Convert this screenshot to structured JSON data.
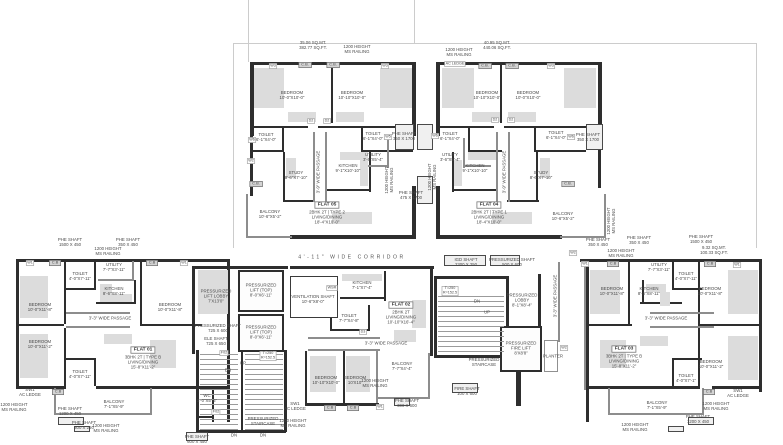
{
  "drawing_title": "TYPICAL FLOOR PLAN",
  "colors": {
    "wall": "#2e2e2e",
    "light_wall": "#8d8d8d",
    "furniture": "#dcdcdc",
    "text": "#4a4a4a",
    "faint_line": "#cccccc"
  },
  "flats": [
    {
      "name": "FLAT 01",
      "type": "3BHK 2T | TYPE B",
      "living": "LIVING/DINING 15'-8\"X11'-2\""
    },
    {
      "name": "FLAT 02",
      "type": "2BHK 2T",
      "living": "LIVING/DINING 10'-10\"X16'-4\""
    },
    {
      "name": "FLAT 03",
      "type": "3BHK 2T | TYPE B",
      "living": "LIVING/DINING 15'-8\"X11'-2\""
    },
    {
      "name": "FLAT 04",
      "type": "2BHK 2T | TYPE 1",
      "living": "LIVING/DINING 18'-4\"X10'-0\""
    },
    {
      "name": "FLAT 05",
      "type": "2BHK 2T | TYPE 2",
      "living": "LIVING/DINING 18'-4\"X10'-0\""
    }
  ],
  "labels": [
    {
      "id": "area-note-flat05",
      "t": "35.06 SQ.MT.\n382.77 SQ.FT.",
      "x": 313,
      "y": 46
    },
    {
      "id": "railing-note",
      "t": "1200 HEIGHT\nMS RAILING",
      "x": 357,
      "y": 50
    },
    {
      "id": "window-tag",
      "t": "W3",
      "x": 273,
      "y": 66,
      "cls": "tag"
    },
    {
      "id": "cupboard",
      "t": "C.B.",
      "x": 305,
      "y": 65,
      "cls": "cb"
    },
    {
      "id": "cupboard",
      "t": "C.B.",
      "x": 333,
      "y": 65,
      "cls": "cb"
    },
    {
      "id": "window-tag",
      "t": "W3",
      "x": 385,
      "y": 66,
      "cls": "tag"
    },
    {
      "id": "room-bedroom",
      "t": "BEDROOM\n10'-0\"X10'-0\"",
      "x": 292,
      "y": 96
    },
    {
      "id": "room-bedroom",
      "t": "BEDROOM\n10'-10\"X10'-0\"",
      "x": 352,
      "y": 96
    },
    {
      "id": "door-tag",
      "t": "D2",
      "x": 311,
      "y": 121,
      "cls": "tag"
    },
    {
      "id": "door-tag",
      "t": "D2",
      "x": 327,
      "y": 121,
      "cls": "tag"
    },
    {
      "id": "window-tag",
      "t": "W6",
      "x": 252,
      "y": 140,
      "cls": "tag"
    },
    {
      "id": "room-toilet",
      "t": "TOILET\n6'-1\"X4'-0\"",
      "x": 266,
      "y": 138
    },
    {
      "id": "room-toilet",
      "t": "TOILET\n6'-1\"X4'-0\"",
      "x": 373,
      "y": 137
    },
    {
      "id": "window-tag",
      "t": "W5",
      "x": 388,
      "y": 137,
      "cls": "tag"
    },
    {
      "id": "shaft-note",
      "t": "PHE SHAFT\n350 X 1700",
      "x": 404,
      "y": 137
    },
    {
      "id": "window-tag",
      "t": "W2",
      "x": 251,
      "y": 161,
      "cls": "tag"
    },
    {
      "id": "room-study",
      "t": "STUDY\n8'-6\"X7'-10\"",
      "x": 296,
      "y": 176
    },
    {
      "id": "passage-note",
      "t": "3'-9\" WIDE PASSAGE",
      "x": 319,
      "y": 172,
      "v": 1
    },
    {
      "id": "room-kitchen",
      "t": "KITCHEN\n9'-1\"X10'-10\"",
      "x": 348,
      "y": 169
    },
    {
      "id": "room-utility",
      "t": "UTILITY\n3'-6\"X5'-4\"",
      "x": 373,
      "y": 158
    },
    {
      "id": "cupboard",
      "t": "C.B.",
      "x": 256,
      "y": 184,
      "cls": "cb"
    },
    {
      "id": "flat-name",
      "t": "FLAT 05",
      "x": 327,
      "y": 205,
      "cls": "fname"
    },
    {
      "id": "flat-info",
      "t": "2BHK 2T | TYPE 2\nLIVING/DINING\n18'-4\"X10'-0\"",
      "x": 327,
      "y": 218
    },
    {
      "id": "room-balcony",
      "t": "BALCONY\n10'-6\"X5'-2\"",
      "x": 270,
      "y": 215
    },
    {
      "id": "railing-note",
      "t": "1200 HEIGHT\nMS RAILING",
      "x": 390,
      "y": 180,
      "v": 1
    },
    {
      "id": "shaft-note",
      "t": "PHE SHAFT\n475 X 1700",
      "x": 411,
      "y": 196
    },
    {
      "id": "area-note-flat04",
      "t": "40.95 SQ.MT.\n440.06 SQ.FT.",
      "x": 497,
      "y": 46
    },
    {
      "id": "railing-note",
      "t": "1200 HEIGHT\nMS RAILING",
      "x": 459,
      "y": 53
    },
    {
      "id": "ac-ledge",
      "t": "AC LEDGE",
      "x": 455,
      "y": 64,
      "cls": "tag"
    },
    {
      "id": "cupboard",
      "t": "C.B.",
      "x": 485,
      "y": 66,
      "cls": "cb"
    },
    {
      "id": "cupboard",
      "t": "C.B.",
      "x": 512,
      "y": 66,
      "cls": "cb"
    },
    {
      "id": "window-tag",
      "t": "W3",
      "x": 551,
      "y": 66,
      "cls": "tag"
    },
    {
      "id": "room-bedroom",
      "t": "BEDROOM\n10'-10\"X10'-0\"",
      "x": 487,
      "y": 96
    },
    {
      "id": "room-bedroom",
      "t": "BEDROOM\n10'-0\"X10'-0\"",
      "x": 528,
      "y": 96
    },
    {
      "id": "door-tag",
      "t": "D2",
      "x": 495,
      "y": 120,
      "cls": "tag"
    },
    {
      "id": "door-tag",
      "t": "D2",
      "x": 511,
      "y": 120,
      "cls": "tag"
    },
    {
      "id": "window-tag",
      "t": "W6",
      "x": 435,
      "y": 136,
      "cls": "tag"
    },
    {
      "id": "room-toilet",
      "t": "TOILET\n6'-1\"X4'-0\"",
      "x": 450,
      "y": 137
    },
    {
      "id": "room-toilet",
      "t": "TOILET\n6'-1\"X4'-0\"",
      "x": 556,
      "y": 136
    },
    {
      "id": "window-tag",
      "t": "W6",
      "x": 571,
      "y": 137,
      "cls": "tag"
    },
    {
      "id": "shaft-note",
      "t": "PHE SHAFT\n350 X 1700",
      "x": 588,
      "y": 138
    },
    {
      "id": "room-utility",
      "t": "UTILITY\n3'-6\"X5'-4\"",
      "x": 450,
      "y": 158
    },
    {
      "id": "room-kitchen",
      "t": "KITCHEN\n9'-1\"X10'-10\"",
      "x": 475,
      "y": 169
    },
    {
      "id": "passage-note",
      "t": "3'-9\" WIDE PASSAGE",
      "x": 505,
      "y": 172,
      "v": 1
    },
    {
      "id": "room-study",
      "t": "STUDY\n8'-6\"X7'-10\"",
      "x": 541,
      "y": 176
    },
    {
      "id": "cupboard",
      "t": "C.B.",
      "x": 568,
      "y": 184,
      "cls": "cb"
    },
    {
      "id": "flat-name",
      "t": "FLAT 04",
      "x": 489,
      "y": 205,
      "cls": "fname"
    },
    {
      "id": "flat-info",
      "t": "2BHK 2T | TYPE 1\nLIVING/DINING\n18'-4\"X10'-0\"",
      "x": 489,
      "y": 218
    },
    {
      "id": "room-balcony",
      "t": "BALCONY\n10'-6\"X5'-2\"",
      "x": 563,
      "y": 217
    },
    {
      "id": "railing-note",
      "t": "1200 HEIGHT\nMS RAILING",
      "x": 612,
      "y": 221,
      "v": 1
    },
    {
      "id": "railing-note",
      "t": "1200 HEIGHT\nMS RAILING",
      "x": 433,
      "y": 177,
      "v": 1
    },
    {
      "id": "shaft-note",
      "t": "PHE SHAFT\n350 X 450",
      "x": 598,
      "y": 243
    },
    {
      "id": "corridor-label",
      "t": "4'-11\" WIDE CORRIDOR",
      "x": 352,
      "y": 258,
      "cls": "corr"
    },
    {
      "id": "shaft-note",
      "t": "PHE SHAFT\n1500 X 450",
      "x": 70,
      "y": 243
    },
    {
      "id": "shaft-note",
      "t": "PHE SHAFT\n350 X 450",
      "x": 128,
      "y": 243
    },
    {
      "id": "railing-note",
      "t": "1200 HEIGHT\nMS RAILING",
      "x": 108,
      "y": 252
    },
    {
      "id": "window-tag",
      "t": "W1",
      "x": 30,
      "y": 263,
      "cls": "tag"
    },
    {
      "id": "cupboard",
      "t": "C.B",
      "x": 55,
      "y": 263,
      "cls": "cb"
    },
    {
      "id": "cupboard",
      "t": "C.B",
      "x": 152,
      "y": 263,
      "cls": "cb"
    },
    {
      "id": "window-tag",
      "t": "W1",
      "x": 184,
      "y": 263,
      "cls": "tag"
    },
    {
      "id": "room-utility",
      "t": "UTILITY\n7'-7\"X3'-11\"",
      "x": 114,
      "y": 268
    },
    {
      "id": "room-toilet",
      "t": "TOILET\n4'-0\"X7'-11\"",
      "x": 80,
      "y": 277
    },
    {
      "id": "room-kitchen",
      "t": "KITCHEN\n8'-6\"X8'-11\"",
      "x": 114,
      "y": 292
    },
    {
      "id": "room-bedroom",
      "t": "BEDROOM\n10'-0\"X11'-8\"",
      "x": 40,
      "y": 308
    },
    {
      "id": "room-bedroom",
      "t": "BEDROOM\n10'-0\"X11'-8\"",
      "x": 170,
      "y": 308
    },
    {
      "id": "passage-note",
      "t": "3'-3\" WIDE PASSAGE",
      "x": 110,
      "y": 319
    },
    {
      "id": "room-bedroom",
      "t": "BEDROOM\n10'-0\"X11'-2\"",
      "x": 40,
      "y": 345
    },
    {
      "id": "flat-name",
      "t": "FLAT 01",
      "x": 143,
      "y": 350,
      "cls": "fname"
    },
    {
      "id": "flat-info",
      "t": "3BHK 2T | TYPE B\nLIVING/DINING\n15'-8\"X11'-2\"",
      "x": 143,
      "y": 363
    },
    {
      "id": "room-toilet",
      "t": "TOILET\n4'-0\"X7'-11\"",
      "x": 80,
      "y": 375
    },
    {
      "id": "ac-ledge",
      "t": "SW1\nAC LEDGE",
      "x": 30,
      "y": 393
    },
    {
      "id": "cupboard",
      "t": "C.B",
      "x": 58,
      "y": 392,
      "cls": "cb"
    },
    {
      "id": "railing-note",
      "t": "1200 HEIGHT\nMS RAILING",
      "x": 14,
      "y": 408
    },
    {
      "id": "shaft-note",
      "t": "PHE SHAFT\n1200 X 450",
      "x": 70,
      "y": 412
    },
    {
      "id": "room-balcony",
      "t": "BALCONY\n7'-1\"X5'-9\"",
      "x": 114,
      "y": 405
    },
    {
      "id": "shaft-note",
      "t": "PHE SHAFT\n300 X 250",
      "x": 84,
      "y": 426
    },
    {
      "id": "railing-note",
      "t": "1200 HEIGHT\nMS RAILING",
      "x": 106,
      "y": 429
    },
    {
      "id": "lift-lobby",
      "t": "PRESSURIZED\nLIFT LOBBY\n7'X13'0\"",
      "x": 216,
      "y": 297
    },
    {
      "id": "lift",
      "t": "PRESSURIZED\nLIFT (TOP)\n8'-0\"X6'-11\"",
      "x": 261,
      "y": 291
    },
    {
      "id": "lift",
      "t": "PRESSURIZED\nLIFT (TOP)\n8'-0\"X6'-11\"",
      "x": 261,
      "y": 333
    },
    {
      "id": "shaft-note",
      "t": "PRESSURIZED SHAFT\n725 X 600",
      "x": 218,
      "y": 329
    },
    {
      "id": "shaft-note",
      "t": "ELE SHAFT\n725 X 650",
      "x": 216,
      "y": 342
    },
    {
      "id": "door-tag",
      "t": "F02",
      "x": 224,
      "y": 353,
      "cls": "tag"
    },
    {
      "id": "stair-up",
      "t": "UP",
      "x": 243,
      "y": 364
    },
    {
      "id": "stair-dn",
      "t": "DN",
      "x": 228,
      "y": 371
    },
    {
      "id": "tread-note",
      "t": "T=250\nR=152.5",
      "x": 268,
      "y": 356,
      "cls": "tag"
    },
    {
      "id": "room-wc",
      "t": "WC\n3'-0\"X5'-6\"",
      "x": 207,
      "y": 399
    },
    {
      "id": "door-tag",
      "t": "F02",
      "x": 216,
      "y": 412,
      "cls": "tag"
    },
    {
      "id": "staircase",
      "t": "PRESSURIZED\nSTAIRCASE",
      "x": 263,
      "y": 422
    },
    {
      "id": "stair-dn",
      "t": "DN",
      "x": 234,
      "y": 436
    },
    {
      "id": "stair-dn",
      "t": "DN",
      "x": 263,
      "y": 436
    },
    {
      "id": "shaft-note",
      "t": "PHE SHAFT\n600 X 450",
      "x": 197,
      "y": 440
    },
    {
      "id": "ac-ledge",
      "t": "SW1\nAC LEDGE",
      "x": 295,
      "y": 407
    },
    {
      "id": "railing-note",
      "t": "1200 HEIGHT\nMS RAILING",
      "x": 293,
      "y": 424
    },
    {
      "id": "shaft-note",
      "t": "VENTILATION SHAFT\n10'-6\"X8'-0\"",
      "x": 313,
      "y": 300
    },
    {
      "id": "window-tag",
      "t": "WSR",
      "x": 332,
      "y": 288,
      "cls": "tag"
    },
    {
      "id": "room-kitchen",
      "t": "KITCHEN\n7'-1\"X7'-4\"",
      "x": 362,
      "y": 286
    },
    {
      "id": "flat-name",
      "t": "FLAT 02",
      "x": 401,
      "y": 305,
      "cls": "fname"
    },
    {
      "id": "flat-info",
      "t": "2BHK 2T\nLIVING/DINING\n10'-10\"X16'-4\"",
      "x": 401,
      "y": 318
    },
    {
      "id": "room-toilet",
      "t": "TOILET\n7'-7\"X4'-8\"",
      "x": 349,
      "y": 319
    },
    {
      "id": "door-tag",
      "t": "D3",
      "x": 363,
      "y": 332,
      "cls": "tag"
    },
    {
      "id": "passage-note",
      "t": "3'-3\" WIDE PASSAGE",
      "x": 386,
      "y": 344
    },
    {
      "id": "room-bedroom",
      "t": "BEDROOM\n10'-10\"X10'-0\"",
      "x": 326,
      "y": 381
    },
    {
      "id": "room-bedroom",
      "t": "BEDROOM\n10'X10'",
      "x": 355,
      "y": 381
    },
    {
      "id": "room-balcony",
      "t": "BALCONY\n7'-7\"X4'-4\"",
      "x": 402,
      "y": 367
    },
    {
      "id": "railing-note",
      "t": "1200 HEIGHT\nMS RAILING",
      "x": 375,
      "y": 384
    },
    {
      "id": "shaft-note",
      "t": "PHE SHAFT\n300 X 600",
      "x": 407,
      "y": 404
    },
    {
      "id": "cupboard",
      "t": "C.B",
      "x": 330,
      "y": 408,
      "cls": "cb"
    },
    {
      "id": "cupboard",
      "t": "C.B",
      "x": 353,
      "y": 408,
      "cls": "cb"
    },
    {
      "id": "window-tag",
      "t": "W1",
      "x": 380,
      "y": 407,
      "cls": "tag"
    },
    {
      "id": "shaft-note",
      "t": "IGD SHAFT\n2300 X 250",
      "x": 466,
      "y": 263
    },
    {
      "id": "shaft-note",
      "t": "PRESSURIZED SHAFT\n500 X 600",
      "x": 512,
      "y": 263
    },
    {
      "id": "tread-note",
      "t": "T=250\nR=152.5",
      "x": 450,
      "y": 291,
      "cls": "tag"
    },
    {
      "id": "stair-dn",
      "t": "DN",
      "x": 477,
      "y": 302
    },
    {
      "id": "stair-up",
      "t": "UP",
      "x": 487,
      "y": 313
    },
    {
      "id": "lift-lobby",
      "t": "PRESSURIZED\nLOBBY\n8'-1\"X8'-4\"",
      "x": 522,
      "y": 301
    },
    {
      "id": "lift",
      "t": "PRESSURIZED\nFIRE LIFT\n8'X8'8\"",
      "x": 521,
      "y": 349
    },
    {
      "id": "staircase",
      "t": "PRESSURIZED\nSTAIRCASE",
      "x": 484,
      "y": 363
    },
    {
      "id": "planter",
      "t": "PLANTER",
      "x": 553,
      "y": 357
    },
    {
      "id": "shaft-note",
      "t": "FIRE SHAFT\n100 X 600",
      "x": 467,
      "y": 392
    },
    {
      "id": "window-tag",
      "t": "W2",
      "x": 573,
      "y": 253,
      "cls": "tag"
    },
    {
      "id": "window-tag",
      "t": "W2",
      "x": 564,
      "y": 348,
      "cls": "tag"
    },
    {
      "id": "passage-note",
      "t": "3'-3\" WIDE PASSAGE",
      "x": 556,
      "y": 296,
      "v": 1
    },
    {
      "id": "shaft-note",
      "t": "PHE SHAFT\n350 X 450",
      "x": 639,
      "y": 241
    },
    {
      "id": "shaft-note",
      "t": "PHE SHAFT\n1500 X 450",
      "x": 701,
      "y": 240
    },
    {
      "id": "area-note",
      "t": "9.32 SQ.MT.\n100.33 SQ.FT.",
      "x": 714,
      "y": 251
    },
    {
      "id": "railing-note",
      "t": "1200 HEIGHT\nMS RAILING",
      "x": 621,
      "y": 254
    },
    {
      "id": "window-tag",
      "t": "W1",
      "x": 585,
      "y": 264,
      "cls": "tag"
    },
    {
      "id": "cupboard",
      "t": "C.B",
      "x": 613,
      "y": 264,
      "cls": "cb"
    },
    {
      "id": "cupboard",
      "t": "C.B",
      "x": 710,
      "y": 264,
      "cls": "cb"
    },
    {
      "id": "window-tag",
      "t": "W1",
      "x": 737,
      "y": 265,
      "cls": "tag"
    },
    {
      "id": "room-utility",
      "t": "UTILITY\n7'-7\"X3'-11\"",
      "x": 659,
      "y": 268
    },
    {
      "id": "room-toilet",
      "t": "TOILET\n4'-0\"X7'-11\"",
      "x": 686,
      "y": 277
    },
    {
      "id": "room-kitchen",
      "t": "KITCHEN\n8'-6\"X8'-11\"",
      "x": 649,
      "y": 292
    },
    {
      "id": "room-bedroom",
      "t": "BEDROOM\n10'-0\"X11'-8\"",
      "x": 612,
      "y": 292
    },
    {
      "id": "room-bedroom",
      "t": "BEDROOM\n10'-0\"X11'-8\"",
      "x": 710,
      "y": 292
    },
    {
      "id": "passage-note",
      "t": "3'-3\" WIDE PASSAGE",
      "x": 666,
      "y": 319
    },
    {
      "id": "flat-name",
      "t": "FLAT 03",
      "x": 624,
      "y": 349,
      "cls": "fname"
    },
    {
      "id": "flat-info",
      "t": "3BHK 2T | TYPE B\nLIVING/DINING\n15'-8\"X11'-2\"",
      "x": 624,
      "y": 362
    },
    {
      "id": "room-bedroom",
      "t": "BEDROOM\n10'-0\"X11'-2\"",
      "x": 711,
      "y": 365
    },
    {
      "id": "room-toilet",
      "t": "TOILET\n4'-0\"X7'-1\"",
      "x": 686,
      "y": 379
    },
    {
      "id": "cupboard",
      "t": "C.B",
      "x": 709,
      "y": 392,
      "cls": "cb"
    },
    {
      "id": "ac-ledge",
      "t": "SW1\nAC LEDGE",
      "x": 738,
      "y": 394
    },
    {
      "id": "railing-note",
      "t": "1200 HEIGHT\nMS RAILING",
      "x": 716,
      "y": 407
    },
    {
      "id": "room-balcony",
      "t": "BALCONY\n7'-1\"X5'-9\"",
      "x": 657,
      "y": 406
    },
    {
      "id": "shaft-note",
      "t": "PHE SHAFT\n1200 X 450",
      "x": 698,
      "y": 420
    },
    {
      "id": "railing-note",
      "t": "1200 HEIGHT\nMS RAILING",
      "x": 635,
      "y": 428
    }
  ]
}
